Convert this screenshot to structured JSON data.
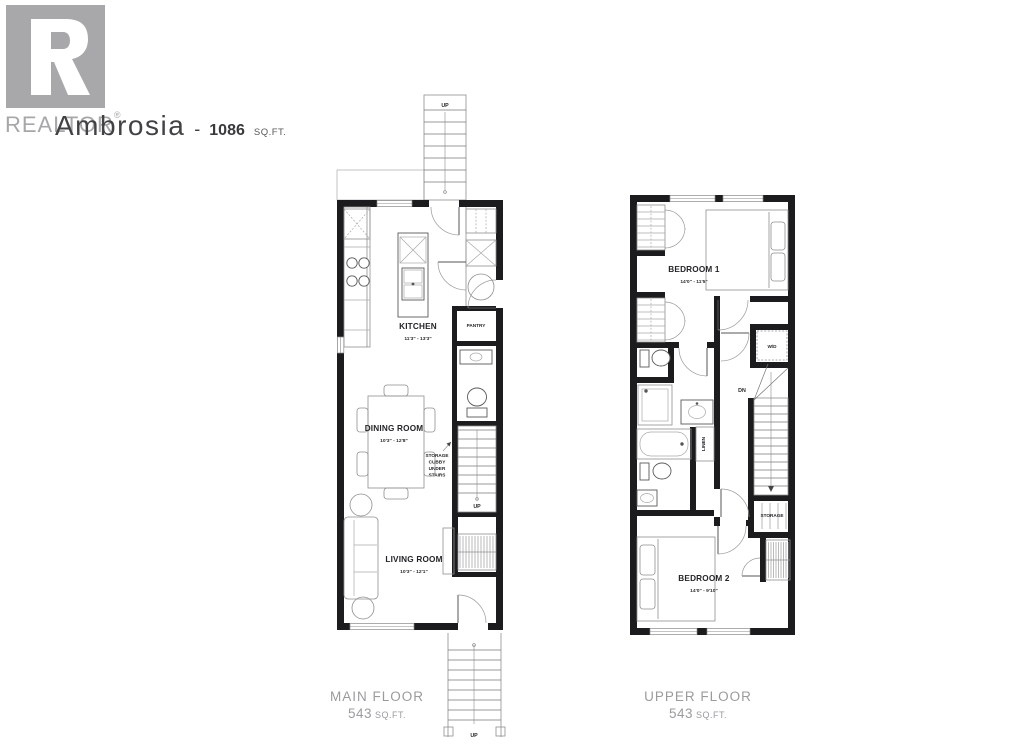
{
  "branding": {
    "logo_letter": "R",
    "logo_word": "REALTOR",
    "logo_registered": "®",
    "logo_color": "#a8a8ab"
  },
  "title": {
    "name": "Ambrosia",
    "separator": "-",
    "area": "1086",
    "unit": "SQ.FT."
  },
  "main_floor": {
    "caption": "MAIN FLOOR",
    "area_value": "543",
    "area_unit": "SQ.FT.",
    "kitchen": {
      "label": "KITCHEN",
      "dims": "11'3\" - 13'3\""
    },
    "dining": {
      "label": "DINING ROOM",
      "dims": "10'3\" - 12'8\""
    },
    "living": {
      "label": "LIVING ROOM",
      "dims": "10'3\" - 12'1\""
    },
    "pantry": "PANTRY",
    "storage_cubby": [
      "STORAGE",
      "CUBBY",
      "UNDER",
      "STAIRS"
    ],
    "up_top": "UP",
    "up_interior": "UP",
    "up_bottom": "UP"
  },
  "upper_floor": {
    "caption": "UPPER FLOOR",
    "area_value": "543",
    "area_unit": "SQ.FT.",
    "bedroom1": {
      "label": "BEDROOM 1",
      "dims": "14'0\" - 11'5\""
    },
    "bedroom2": {
      "label": "BEDROOM 2",
      "dims": "14'0\" - 9'10\""
    },
    "washer_dryer": "W/D",
    "stairs_down": "DN",
    "linen": "LINEN",
    "storage": "STORAGE"
  }
}
